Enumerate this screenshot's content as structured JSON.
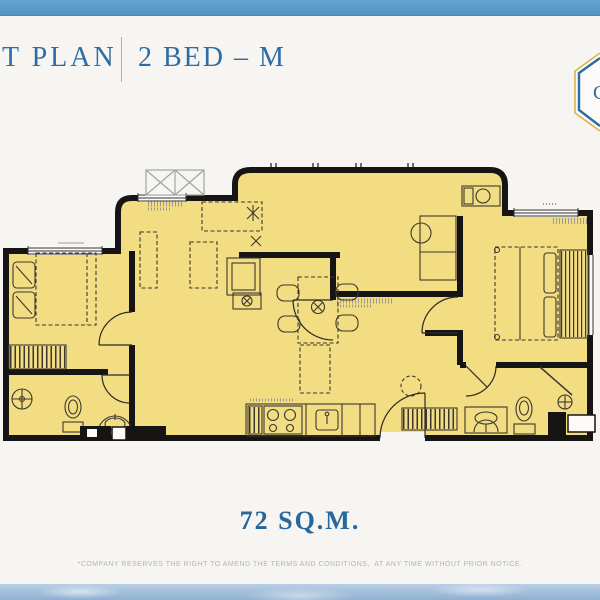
{
  "header": {
    "title_prefix": "T PLAN",
    "title_unit": "2 BED – M",
    "badge_letter": "C"
  },
  "plan": {
    "area": "72 SQ.M.",
    "bedrooms": 2
  },
  "footer": {
    "disclaimer": "*COMPANY RESERVES THE RIGHT TO AMEND THE TERMS AND CONDITIONS,  AT ANY TIME WITHOUT PRIOR NOTICE."
  },
  "colors": {
    "top_bar": "#5b9dcb",
    "title_blue": "#2d6da6",
    "area_blue": "#27679c",
    "plan_fill": "#f2dd82",
    "wall_black": "#171513",
    "badge_gold": "#d9b44a",
    "badge_blue": "#2d6ba3",
    "disclaimer_gray": "#b4b4b1",
    "sky_band_blue": "#8fb0d2"
  }
}
